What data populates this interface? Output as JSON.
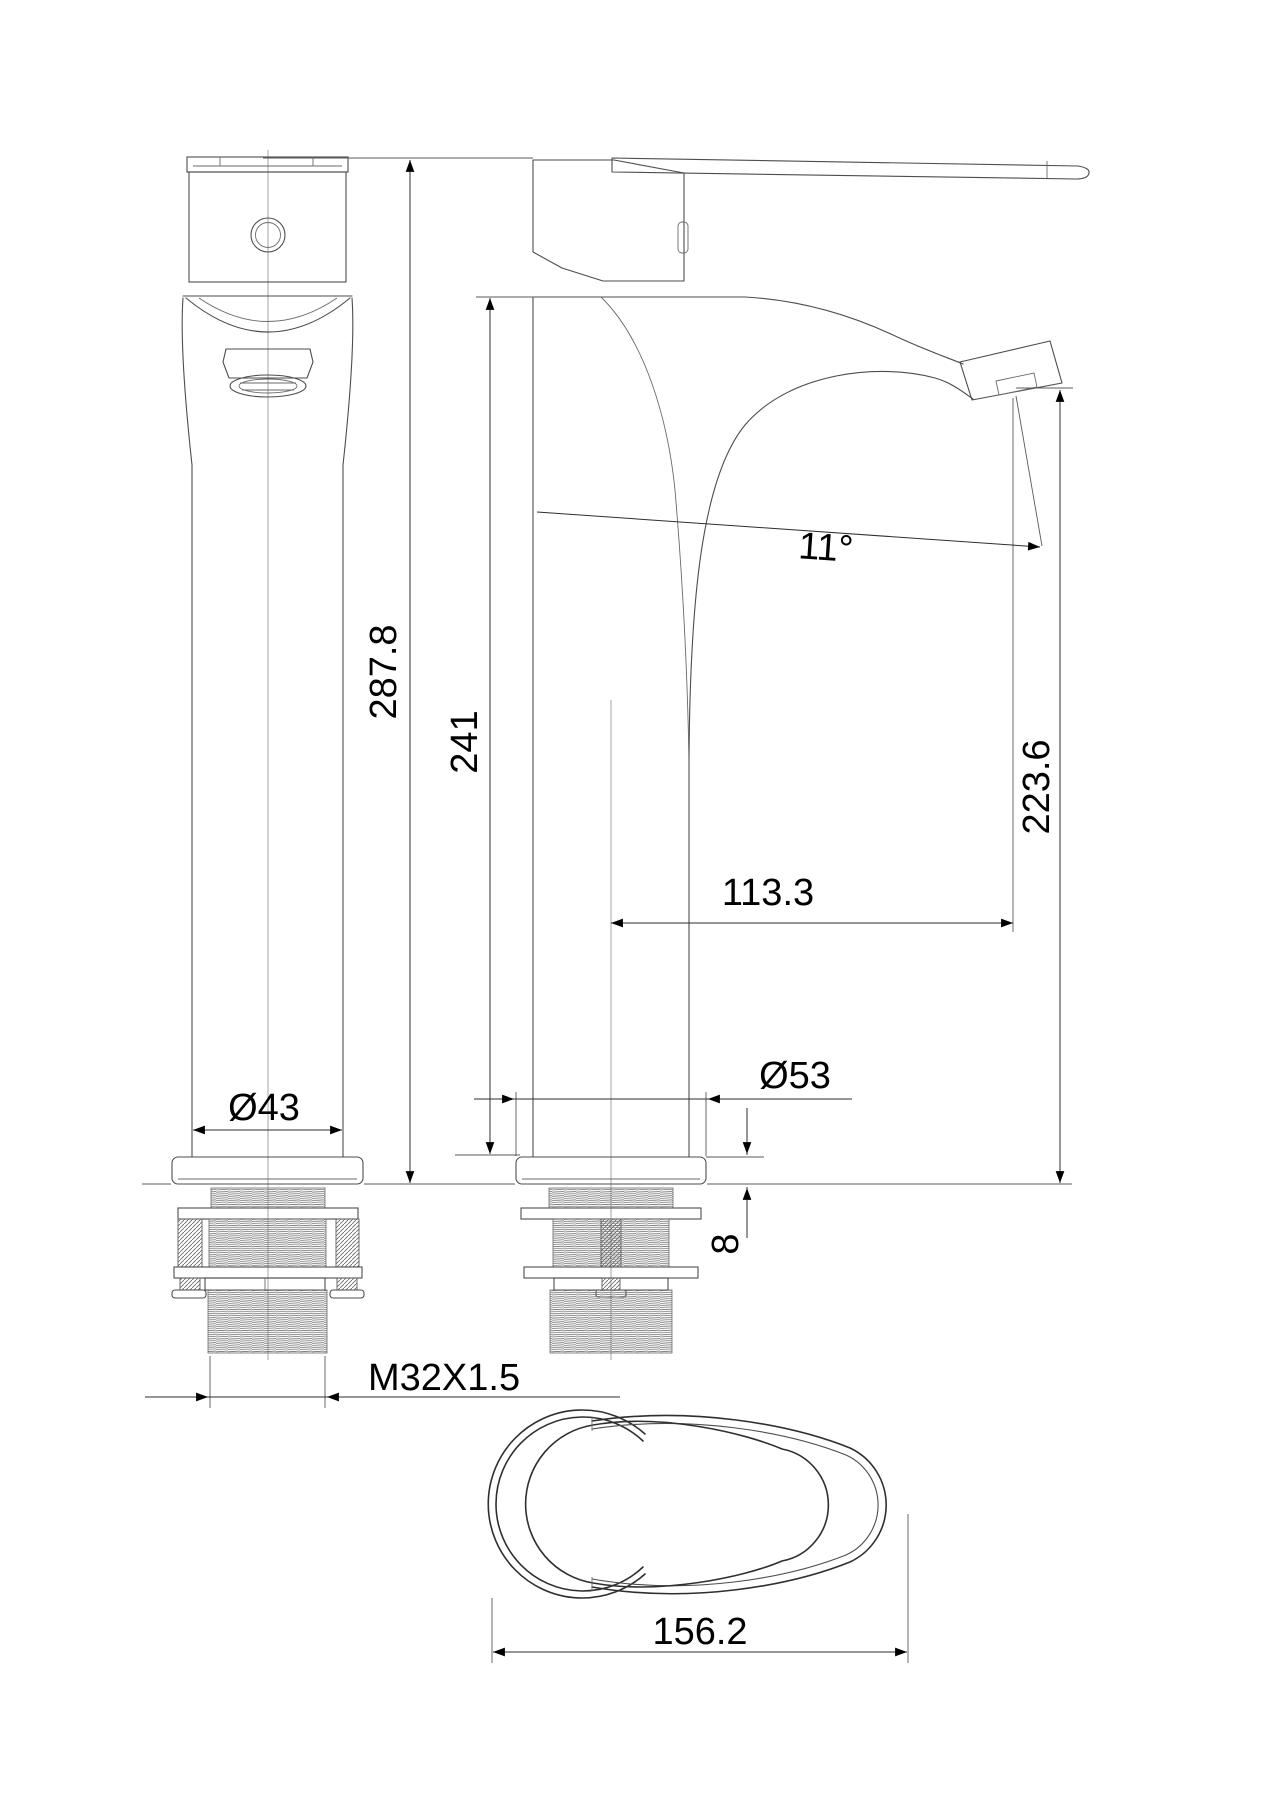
{
  "drawing": {
    "dimensions": {
      "total_height": "287.8",
      "body_height": "241",
      "spout_height": "223.6",
      "spout_reach": "113.3",
      "spout_angle": "11°",
      "body_diameter": "Ø43",
      "base_diameter": "Ø53",
      "flange_thickness": "8",
      "thread_spec": "M32X1.5",
      "handle_length": "156.2"
    },
    "colors": {
      "background": "#ffffff",
      "object_line": "#4d4d4d",
      "dimension_line": "#2e2e2e",
      "text": "#000000"
    }
  }
}
